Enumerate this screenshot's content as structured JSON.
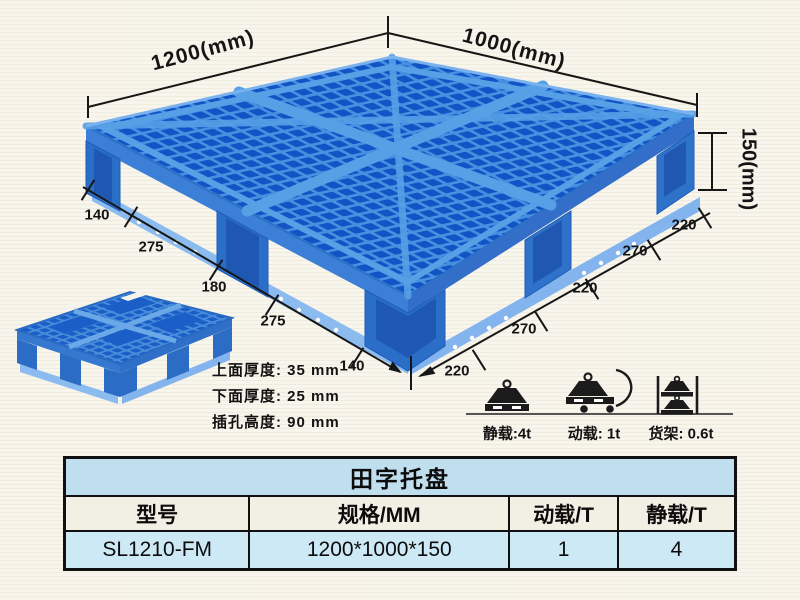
{
  "product_diagram": {
    "dim_top_left": "1200(mm)",
    "dim_top_right": "1000(mm)",
    "dim_height": "150(mm)",
    "left_edge_dims": [
      "140",
      "275",
      "180",
      "275",
      "140"
    ],
    "right_edge_dims": [
      "220",
      "270",
      "220",
      "270",
      "220"
    ],
    "thickness_notes": {
      "top_thickness": "上面厚度: 35 mm",
      "bottom_thickness": "下面厚度: 25 mm",
      "fork_hole_height": "插孔高度: 90 mm"
    }
  },
  "load_ratings": {
    "static": "静载:4t",
    "dynamic": "动载: 1t",
    "rack": "货架: 0.6t"
  },
  "spec_table": {
    "title": "田字托盘",
    "columns": [
      "型号",
      "规格/MM",
      "动载/T",
      "静载/T"
    ],
    "row": {
      "model": "SL1210-FM",
      "spec_mm": "1200*1000*150",
      "dynamic_load_t": "1",
      "static_load_t": "4"
    }
  },
  "colors": {
    "pallet_rib_blue": "#4690e0",
    "pallet_hole_blue": "#1254c6",
    "pallet_side_blue": "#3b80d6",
    "runner_light_blue": "#8cbbf0",
    "background_cream": "#f8f5ec",
    "table_title_bg": "#bfdfee",
    "table_header_bg": "#f2efe4",
    "table_data_bg": "#cde9f5",
    "line_black": "#161616"
  }
}
